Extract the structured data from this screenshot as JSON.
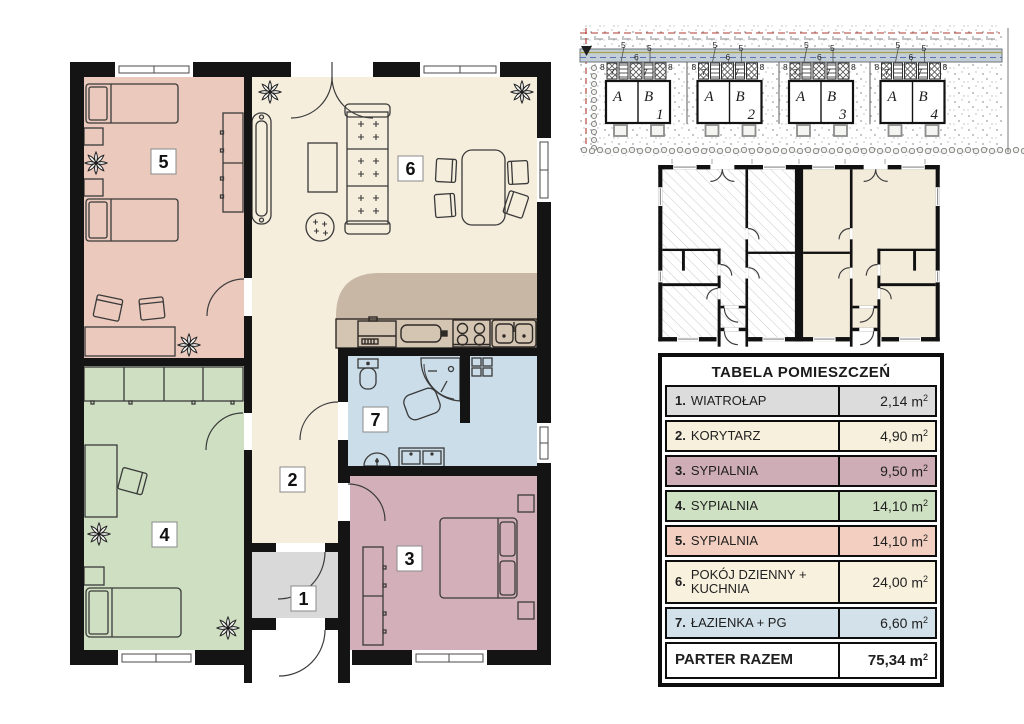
{
  "site_plan": {
    "buildings": [
      {
        "unit_a": "A",
        "unit_b": "B",
        "number": "1"
      },
      {
        "unit_a": "A",
        "unit_b": "B",
        "number": "2"
      },
      {
        "unit_a": "A",
        "unit_b": "B",
        "number": "3"
      },
      {
        "unit_a": "A",
        "unit_b": "B",
        "number": "4"
      }
    ],
    "callouts": {
      "c5": "5",
      "c6": "6",
      "c7": "7",
      "c8": "8"
    }
  },
  "floor_plan": {
    "room_numbers": [
      "1",
      "2",
      "3",
      "4",
      "5",
      "6",
      "7"
    ]
  },
  "table": {
    "title": "TABELA POMIESZCZEŃ",
    "unit_base": "m",
    "unit_sup": "2",
    "rows": [
      {
        "num": "1.",
        "name": "WIATROŁAP",
        "area": "2,14",
        "color": "#dcdcdc"
      },
      {
        "num": "2.",
        "name": "KORYTARZ",
        "area": "4,90",
        "color": "#f7f0dc"
      },
      {
        "num": "3.",
        "name": "SYPIALNIA",
        "area": "9,50",
        "color": "#cfadb7"
      },
      {
        "num": "4.",
        "name": "SYPIALNIA",
        "area": "14,10",
        "color": "#cfe1c3"
      },
      {
        "num": "5.",
        "name": "SYPIALNIA",
        "area": "14,10",
        "color": "#f2cfc0"
      },
      {
        "num": "6.",
        "name": "POKÓJ DZIENNY + KUCHNIA",
        "area": "24,00",
        "color": "#f8f1de"
      },
      {
        "num": "7.",
        "name": "ŁAZIENKA + PG",
        "area": "6,60",
        "color": "#d2e1ea"
      }
    ],
    "total": {
      "label": "PARTER RAZEM",
      "area": "75,34"
    }
  },
  "colors": {
    "wall": "#141414",
    "bedroom5": "#ebc9bd",
    "bedroom4": "#cfe0c2",
    "bedroom3": "#d3b0b9",
    "bathroom": "#cbdde9",
    "living": "#f5eedd",
    "kitchen": "#c9b7a5",
    "counter": "#d4c5b3",
    "entry": "#d9d9d9",
    "mini_cream": "#f3ecda"
  }
}
